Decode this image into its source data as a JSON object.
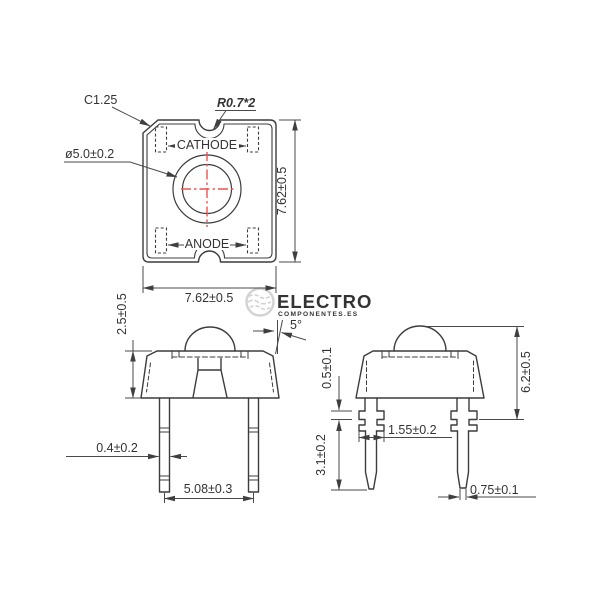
{
  "colors": {
    "line": "#3c3c3c",
    "dim_line": "#4a4a4a",
    "text": "#333333",
    "crosshair_red": "#ee544e",
    "watermark": "#d2d2d2",
    "watermark_sub": "#dedede",
    "background": "#ffffff"
  },
  "top_view": {
    "chamfer_label": "C1.25",
    "corner_radius_label": "R0.7*2",
    "hole_diameter_label": "ø5.0±0.2",
    "cathode_label": "CATHODE",
    "anode_label": "ANODE",
    "height_dim": "7.62±0.5",
    "width_dim": "7.62±0.5"
  },
  "front_view": {
    "body_height_dim": "2.5±0.5",
    "lead_thickness_dim": "0.4±0.2",
    "lead_pitch_dim": "5.08±0.3",
    "draft_angle_label": "5°"
  },
  "side_view": {
    "standoff_height_dim": "0.5±0.1",
    "lead_length_dim": "3.1±0.2",
    "standoff_width_dim": "1.55±0.2",
    "overall_height_dim": "6.2±0.5",
    "lead_tip_dim": "0.75±0.1"
  },
  "watermark": {
    "brand": "ELECTRO",
    "tagline": "COMPONENTES.ES"
  }
}
